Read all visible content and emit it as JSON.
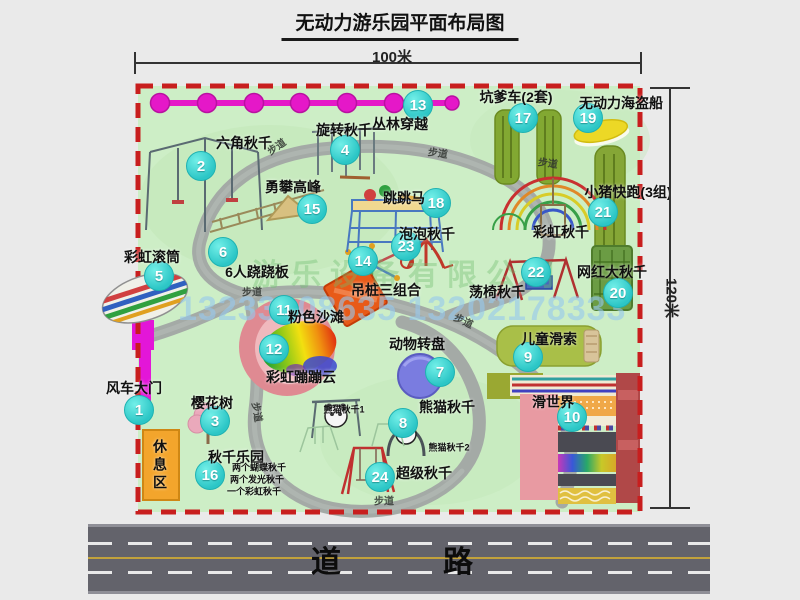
{
  "title": "无动力游乐园平面布局图",
  "dimensions": {
    "width_label": "100米",
    "height_label": "120米"
  },
  "road": {
    "label": "道　　路"
  },
  "watermark": {
    "phone": "13233808635 13202178333",
    "company": "游乐设备有限公司"
  },
  "colors": {
    "park_green": "#cdeec6",
    "border_red": "#c81e1e",
    "badge_teal": "#2cc6c6",
    "path_gray": "#a4aaa6",
    "road_gray": "#63636b",
    "gate_magenta": "#e316d8",
    "rest_orange": "#f3a52c"
  },
  "map": {
    "items": [
      {
        "num": "1",
        "label": "风车大门",
        "lx": 134,
        "ly": 388,
        "bx": 139,
        "by": 410
      },
      {
        "num": "2",
        "label": "六角秋千",
        "lx": 244,
        "ly": 143,
        "bx": 201,
        "by": 166
      },
      {
        "num": "3",
        "label": "樱花树",
        "lx": 212,
        "ly": 403,
        "bx": 215,
        "by": 421
      },
      {
        "num": "4",
        "label": "旋转秋千",
        "lx": 344,
        "ly": 130,
        "bx": 345,
        "by": 150
      },
      {
        "num": "5",
        "label": "彩虹滚筒",
        "lx": 152,
        "ly": 257,
        "bx": 159,
        "by": 276
      },
      {
        "num": "6",
        "label": "6人跷跷板",
        "lx": 257,
        "ly": 272,
        "bx": 223,
        "by": 252
      },
      {
        "num": "7",
        "label": "动物转盘",
        "lx": 417,
        "ly": 344,
        "bx": 440,
        "by": 372
      },
      {
        "num": "8",
        "label": "熊猫秋千",
        "lx": 447,
        "ly": 407,
        "bx": 403,
        "by": 423
      },
      {
        "num": "9",
        "label": "儿童滑索",
        "lx": 549,
        "ly": 339,
        "bx": 528,
        "by": 357
      },
      {
        "num": "10",
        "label": "滑世界",
        "lx": 553,
        "ly": 402,
        "bx": 572,
        "by": 417
      },
      {
        "num": "11",
        "label": "粉色沙滩",
        "lx": 316,
        "ly": 317,
        "bx": 284,
        "by": 310
      },
      {
        "num": "12",
        "label": "彩虹蹦蹦云",
        "lx": 301,
        "ly": 377,
        "bx": 274,
        "by": 349
      },
      {
        "num": "13",
        "label": "丛林穿越",
        "lx": 400,
        "ly": 124,
        "bx": 418,
        "by": 105
      },
      {
        "num": "14",
        "label": "吊桩三组合",
        "lx": 386,
        "ly": 290,
        "bx": 363,
        "by": 261
      },
      {
        "num": "15",
        "label": "勇攀高峰",
        "lx": 293,
        "ly": 187,
        "bx": 312,
        "by": 209
      },
      {
        "num": "16",
        "label": "秋千乐园",
        "lx": 236,
        "ly": 457,
        "bx": 210,
        "by": 475
      },
      {
        "num": "17",
        "label": "坑爹车(2套)",
        "lx": 516,
        "ly": 97,
        "bx": 523,
        "by": 118
      },
      {
        "num": "18",
        "label": "跳跳马",
        "lx": 404,
        "ly": 198,
        "bx": 436,
        "by": 203
      },
      {
        "num": "19",
        "label": "无动力海盗船",
        "lx": 621,
        "ly": 103,
        "bx": 588,
        "by": 118
      },
      {
        "num": "20",
        "label": "网红大秋千",
        "lx": 612,
        "ly": 272,
        "bx": 618,
        "by": 293
      },
      {
        "num": "21",
        "label": "小猪快跑(3组)",
        "lx": 628,
        "ly": 192,
        "bx": 603,
        "by": 212
      },
      {
        "num": "22",
        "label": "荡椅秋千",
        "lx": 497,
        "ly": 292,
        "bx": 536,
        "by": 272
      },
      {
        "num": "23",
        "label": "泡泡秋千",
        "lx": 427,
        "ly": 234,
        "bx": 406,
        "by": 246
      },
      {
        "num": "24",
        "label": "超级秋千",
        "lx": 424,
        "ly": 473,
        "bx": 380,
        "by": 477
      },
      {
        "num": "",
        "label": "彩虹秋千",
        "lx": 561,
        "ly": 232
      }
    ],
    "sub_labels": [
      {
        "text": "休息区",
        "x": 160,
        "y": 466,
        "size": 14,
        "vertical": true
      },
      {
        "text": "熊猫秋千1",
        "x": 344,
        "y": 409,
        "size": 9
      },
      {
        "text": "熊猫秋千2",
        "x": 449,
        "y": 447,
        "size": 9
      },
      {
        "text": "两个蝴蝶秋千",
        "x": 259,
        "y": 467,
        "size": 9
      },
      {
        "text": "两个发光秋千",
        "x": 257,
        "y": 479,
        "size": 9
      },
      {
        "text": "一个彩虹秋千",
        "x": 254,
        "y": 491,
        "size": 9
      }
    ],
    "path_labels": [
      {
        "text": "步道",
        "x": 276,
        "y": 146,
        "r": -35
      },
      {
        "text": "步道",
        "x": 438,
        "y": 152,
        "r": 8
      },
      {
        "text": "步道",
        "x": 548,
        "y": 162,
        "r": 8
      },
      {
        "text": "步道",
        "x": 252,
        "y": 291,
        "r": 0
      },
      {
        "text": "步道",
        "x": 258,
        "y": 412,
        "r": 80
      },
      {
        "text": "步道",
        "x": 464,
        "y": 320,
        "r": 25
      },
      {
        "text": "步道",
        "x": 384,
        "y": 500,
        "r": 0
      }
    ]
  }
}
